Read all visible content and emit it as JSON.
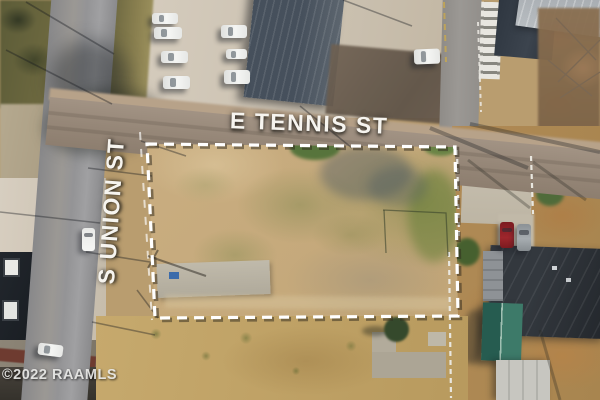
{
  "scene": {
    "type": "aerial-drone-photo",
    "subject": "vacant corner lot outlined with white dashed property boundary at street intersection",
    "street_label_horizontal": "E TENNIS ST",
    "street_label_vertical": "S UNION ST",
    "watermark": "©2022 RAAMLS",
    "visible_vehicles": {
      "parking_lot_white_vehicles": 7,
      "white_van_on_right_street": 1,
      "white_car_on_s_union_st": 1,
      "white_car_bottom_left_road": 1,
      "red_car_in_driveway": 1,
      "silver_car_in_driveway": 1
    }
  },
  "palette": {
    "dirt_base": "#b99d6f",
    "lot_dirt": "#cdb286",
    "lot_dirt_dark": "#bfa273",
    "field_south": "#c6a96d",
    "grass_rust": "#b08a55",
    "road_gray": "#9b9894",
    "road_brown": "#968778",
    "concrete_light": "#d7cec0",
    "concrete_pad": "#b0aa9b",
    "roof_ribbed_slate": "#46505c",
    "roof_metal_light": "#a6abb0",
    "roof_house_dark": "#23272c",
    "shed_teal": "#3d7a69",
    "shed_white": "#c7c6c0",
    "building_dark_left": "#22272d",
    "maroon_strip": "#6e3b30",
    "car_white": "#f4f5f3",
    "car_red": "#9e262c",
    "car_gray": "#a6acb0",
    "boundary_white": "#ffffff",
    "label_white": "#f6f4ef",
    "watermark": "#e8e8e6",
    "curb_yellow": "#c9a94e"
  }
}
